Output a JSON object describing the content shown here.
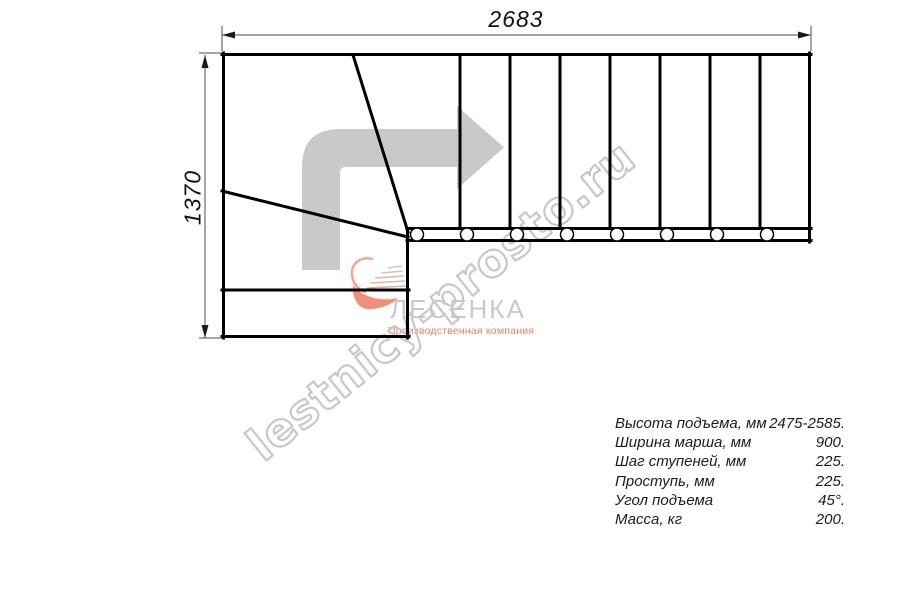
{
  "dimensions": {
    "width_mm": "2683",
    "height_mm": "1370"
  },
  "watermark": "lestnicy-prosto.ru",
  "logo": {
    "brand": "ЛЕСЕНКА",
    "tagline": "Производственная компания"
  },
  "specs": [
    {
      "label": "Высота подъема, мм",
      "value": "2475-2585."
    },
    {
      "label": "Ширина марша, мм",
      "value": "900."
    },
    {
      "label": "Шаг ступеней, мм",
      "value": "225."
    },
    {
      "label": "Проступь, мм",
      "value": "225."
    },
    {
      "label": "Угол подъема",
      "value": "45°."
    },
    {
      "label": "Масса, кг",
      "value": "200."
    }
  ],
  "colors": {
    "line": "#000000",
    "dimension": "#4d4d4d",
    "direction_arrow": "#c9c9c9",
    "watermark": "#c8c8c8",
    "brand_gray": "#c9c9c9",
    "accent_orange": "#ee8166",
    "swoosh": "#f19078"
  }
}
